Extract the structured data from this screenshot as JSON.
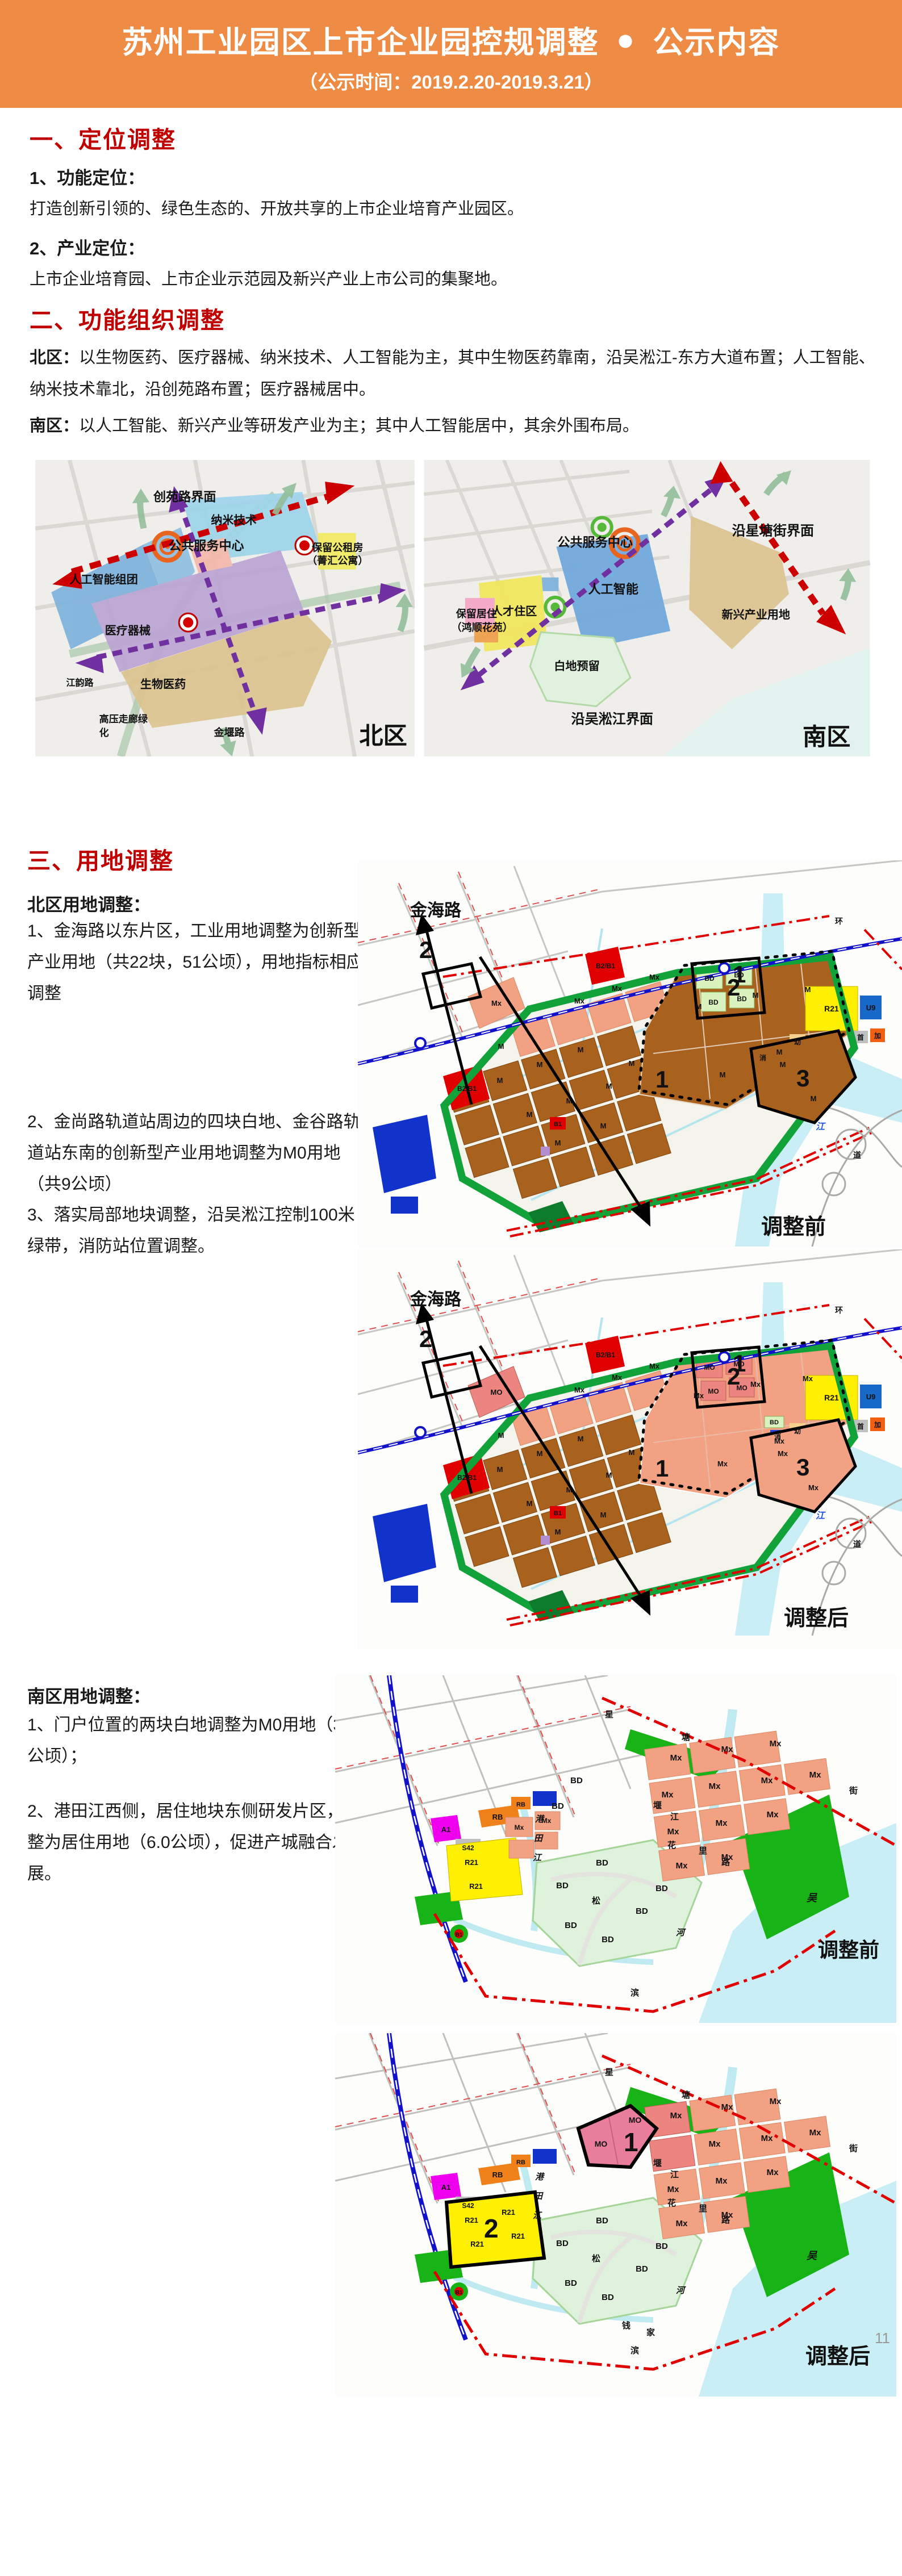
{
  "header": {
    "title": "苏州工业园区上市企业园控规调整",
    "bullet": "●",
    "title2": "公示内容",
    "date": "（公示时间：2019.2.20-2019.3.21）"
  },
  "s1": {
    "heading": "一、定位调整",
    "item1_title": "1、功能定位：",
    "item1_body": "打造创新引领的、绿色生态的、开放共享的上市企业培育产业园区。",
    "item2_title": "2、产业定位：",
    "item2_body": "上市企业培育园、上市企业示范园及新兴产业上市公司的集聚地。"
  },
  "s2": {
    "heading": "二、功能组织调整",
    "north_label": "北区：",
    "north_body": "以生物医药、医疗器械、纳米技术、人工智能为主，其中生物医药靠南，沿吴淞江-东方大道布置；人工智能、纳米技术靠北，沿创苑路布置；医疗器械居中。",
    "south_label": "南区：",
    "south_body": "以人工智能、新兴产业等研发产业为主；其中人工智能居中，其余外围布局。"
  },
  "nmap": {
    "chuangyuan": "创苑路界面",
    "nano": "纳米技术",
    "service": "公共服务中心",
    "gongzu1": "保留公租房",
    "gongzu2": "（菁汇公寓）",
    "ai": "人工智能组团",
    "medical": "医疗器械",
    "bio": "生物医药",
    "jiangyun": "江韵路",
    "gaoya1": "高压走廊绿",
    "gaoya2": "化",
    "jinyan": "金堰路",
    "caption": "北区"
  },
  "smap": {
    "xingtang": "沿星塘街界面",
    "service": "公共服务中心",
    "ai": "人工智能",
    "xinxing": "新兴产业用地",
    "baoliu1": "保留居住",
    "baoliu2": "（鸿顺花苑）",
    "rencai": "人才住区",
    "baidi": "白地预留",
    "wusong": "沿吴淞江界面",
    "caption": "南区"
  },
  "s3": {
    "heading": "三、用地调整",
    "north_sub": "北区用地调整：",
    "n1": "1、金海路以东片区，工业用地调整为创新型产业用地（共22块，51公顷），用地指标相应调整",
    "n2": "2、金尚路轨道站周边的四块白地、金谷路轨道站东南的创新型产业用地调整为M0用地（共9公顷）",
    "n3": "3、落实局部地块调整，沿吴淞江控制100米绿带，消防站位置调整。",
    "south_sub": "南区用地调整：",
    "south1": "1、门户位置的两块白地调整为M0用地（3.4公顷）；",
    "south2": "2、港田江西侧，居住地块东侧研发片区，调整为居住用地（6.0公顷），促进产城融合发展。"
  },
  "cad": {
    "jinhai": "金海路",
    "before": "调整前",
    "after": "调整后",
    "codes": {
      "M": "M",
      "Mx": "Mx",
      "MO": "MO",
      "BD": "BD",
      "R21": "R21",
      "B2B1": "B2/B1",
      "B1": "B1",
      "U9": "U9",
      "A1": "A1",
      "RB": "RB",
      "S42": "S42",
      "you": "幼",
      "shou": "首",
      "jia": "加",
      "xiao": "消"
    },
    "markers": {
      "m1": "1",
      "m2": "2",
      "m3": "3"
    },
    "roads": {
      "huan": "环",
      "dao": "道",
      "jiang": "江",
      "wu": "吴",
      "xing": "星",
      "tang": "塘",
      "jie": "街",
      "song": "松",
      "bin": "滨",
      "hua": "花",
      "li": "里",
      "lu": "路",
      "yan": "堰",
      "gang": "港",
      "tian": "田",
      "he": "河",
      "qian": "钱",
      "jia2": "家"
    }
  },
  "page": {
    "number": "11"
  },
  "colors": {
    "header_bg": "#EE8B45",
    "heading_red": "#C00000",
    "text": "#1A1A1A",
    "parcel_industry_brown": "#A9611E",
    "parcel_mx_pink": "#F2A183",
    "parcel_mo": "#EC8580",
    "parcel_mo_south": "#E87E9B",
    "parcel_bd_green": "#D9F2BE",
    "parcel_r21_yellow": "#FFF000",
    "parcel_commercial_red": "#E00000",
    "parcel_blue": "#1133CC",
    "green_belt": "#17B317",
    "water_cyan": "#C9EEF5",
    "metro_blue": "#1212CC",
    "axis_red": "#CC0000",
    "axis_purple": "#7030A0"
  }
}
